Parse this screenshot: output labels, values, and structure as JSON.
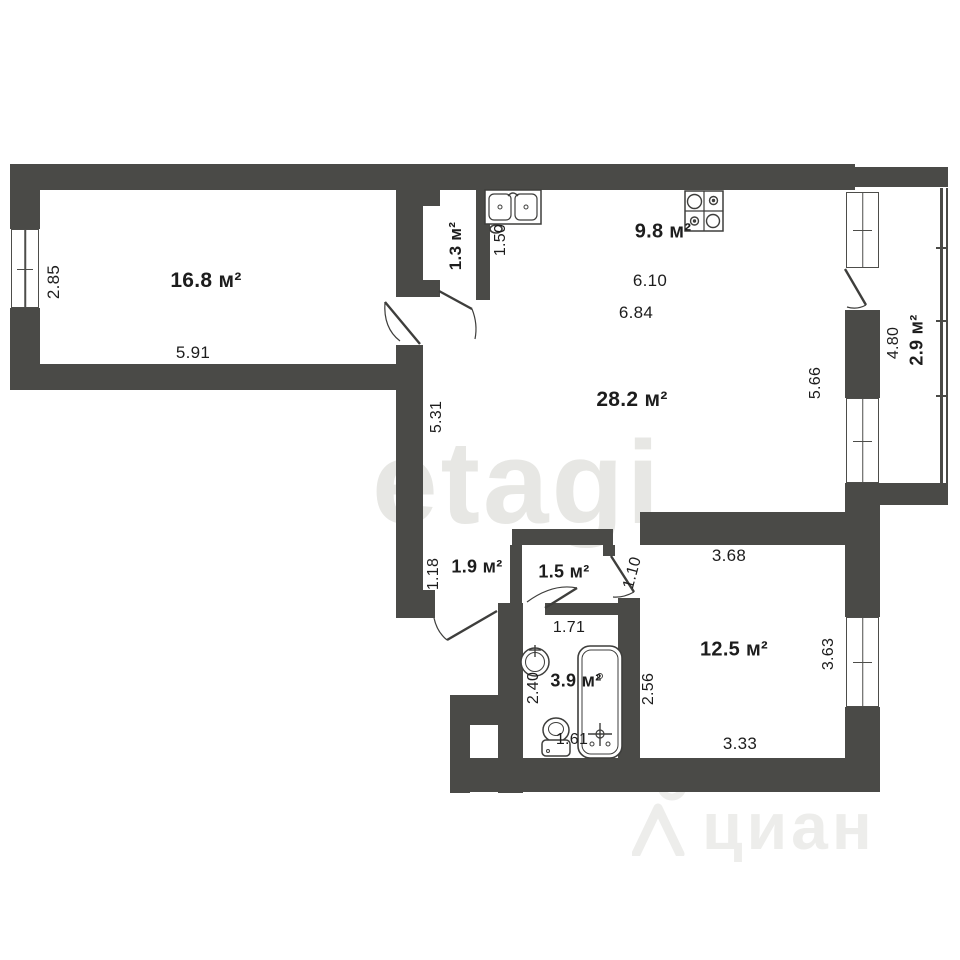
{
  "document_type": "apartment floor plan",
  "colors": {
    "background": "#ffffff",
    "wall": "#4a4a47",
    "fixture_line": "#3e3e3c",
    "label_text": "#1d1d1d",
    "watermark_center": "#e7e7e4",
    "watermark_corner": "#ededeb"
  },
  "rooms": [
    {
      "id": "room-1",
      "area": "16.8 м²",
      "dimensions": [
        "2.85",
        "5.91"
      ]
    },
    {
      "id": "closet",
      "area": "1.3 м²",
      "dimensions": [
        "1.50"
      ]
    },
    {
      "id": "kitchen-zone",
      "area": "9.8 м²",
      "dimensions": [
        "6.10",
        "6.84"
      ]
    },
    {
      "id": "living-zone",
      "area": "28.2 м²",
      "dimensions": [
        "5.31",
        "5.66"
      ]
    },
    {
      "id": "balcony",
      "area": "2.9 м²",
      "dimensions": [
        "4.80"
      ]
    },
    {
      "id": "hallway",
      "area": "1.9 м²",
      "dimensions": [
        "1.18"
      ]
    },
    {
      "id": "hall",
      "area": "1.5 м²",
      "dimensions": [
        "1.10",
        "1.71"
      ]
    },
    {
      "id": "bathroom",
      "area": "3.9 м²",
      "dimensions": [
        "2.40",
        "1.61",
        "2.56"
      ]
    },
    {
      "id": "room-2",
      "area": "12.5 м²",
      "dimensions": [
        "3.68",
        "3.63",
        "3.33"
      ]
    }
  ],
  "fixtures": [
    "kitchen-double-sink",
    "stove",
    "washbasin",
    "toilet",
    "bathtub"
  ],
  "watermarks": {
    "center_text": "etagi",
    "bottom_right_text": "циан"
  },
  "labels": [
    {
      "text": "16.8 м²",
      "kind": "area"
    },
    {
      "text": "1.3 м²",
      "kind": "area"
    },
    {
      "text": "9.8 м²",
      "kind": "area"
    },
    {
      "text": "28.2 м²",
      "kind": "area"
    },
    {
      "text": "2.9 м²",
      "kind": "area"
    },
    {
      "text": "1.9 м²",
      "kind": "area"
    },
    {
      "text": "1.5 м²",
      "kind": "area"
    },
    {
      "text": "3.9 м²",
      "kind": "area"
    },
    {
      "text": "12.5 м²",
      "kind": "area"
    },
    {
      "text": "2.85",
      "kind": "dimension"
    },
    {
      "text": "5.91",
      "kind": "dimension"
    },
    {
      "text": "1.50",
      "kind": "dimension"
    },
    {
      "text": "6.10",
      "kind": "dimension"
    },
    {
      "text": "6.84",
      "kind": "dimension"
    },
    {
      "text": "5.31",
      "kind": "dimension"
    },
    {
      "text": "5.66",
      "kind": "dimension"
    },
    {
      "text": "4.80",
      "kind": "dimension"
    },
    {
      "text": "1.18",
      "kind": "dimension"
    },
    {
      "text": "1.10",
      "kind": "dimension"
    },
    {
      "text": "1.71",
      "kind": "dimension"
    },
    {
      "text": "2.40",
      "kind": "dimension"
    },
    {
      "text": "1.61",
      "kind": "dimension"
    },
    {
      "text": "2.56",
      "kind": "dimension"
    },
    {
      "text": "3.68",
      "kind": "dimension"
    },
    {
      "text": "3.63",
      "kind": "dimension"
    },
    {
      "text": "3.33",
      "kind": "dimension"
    }
  ]
}
